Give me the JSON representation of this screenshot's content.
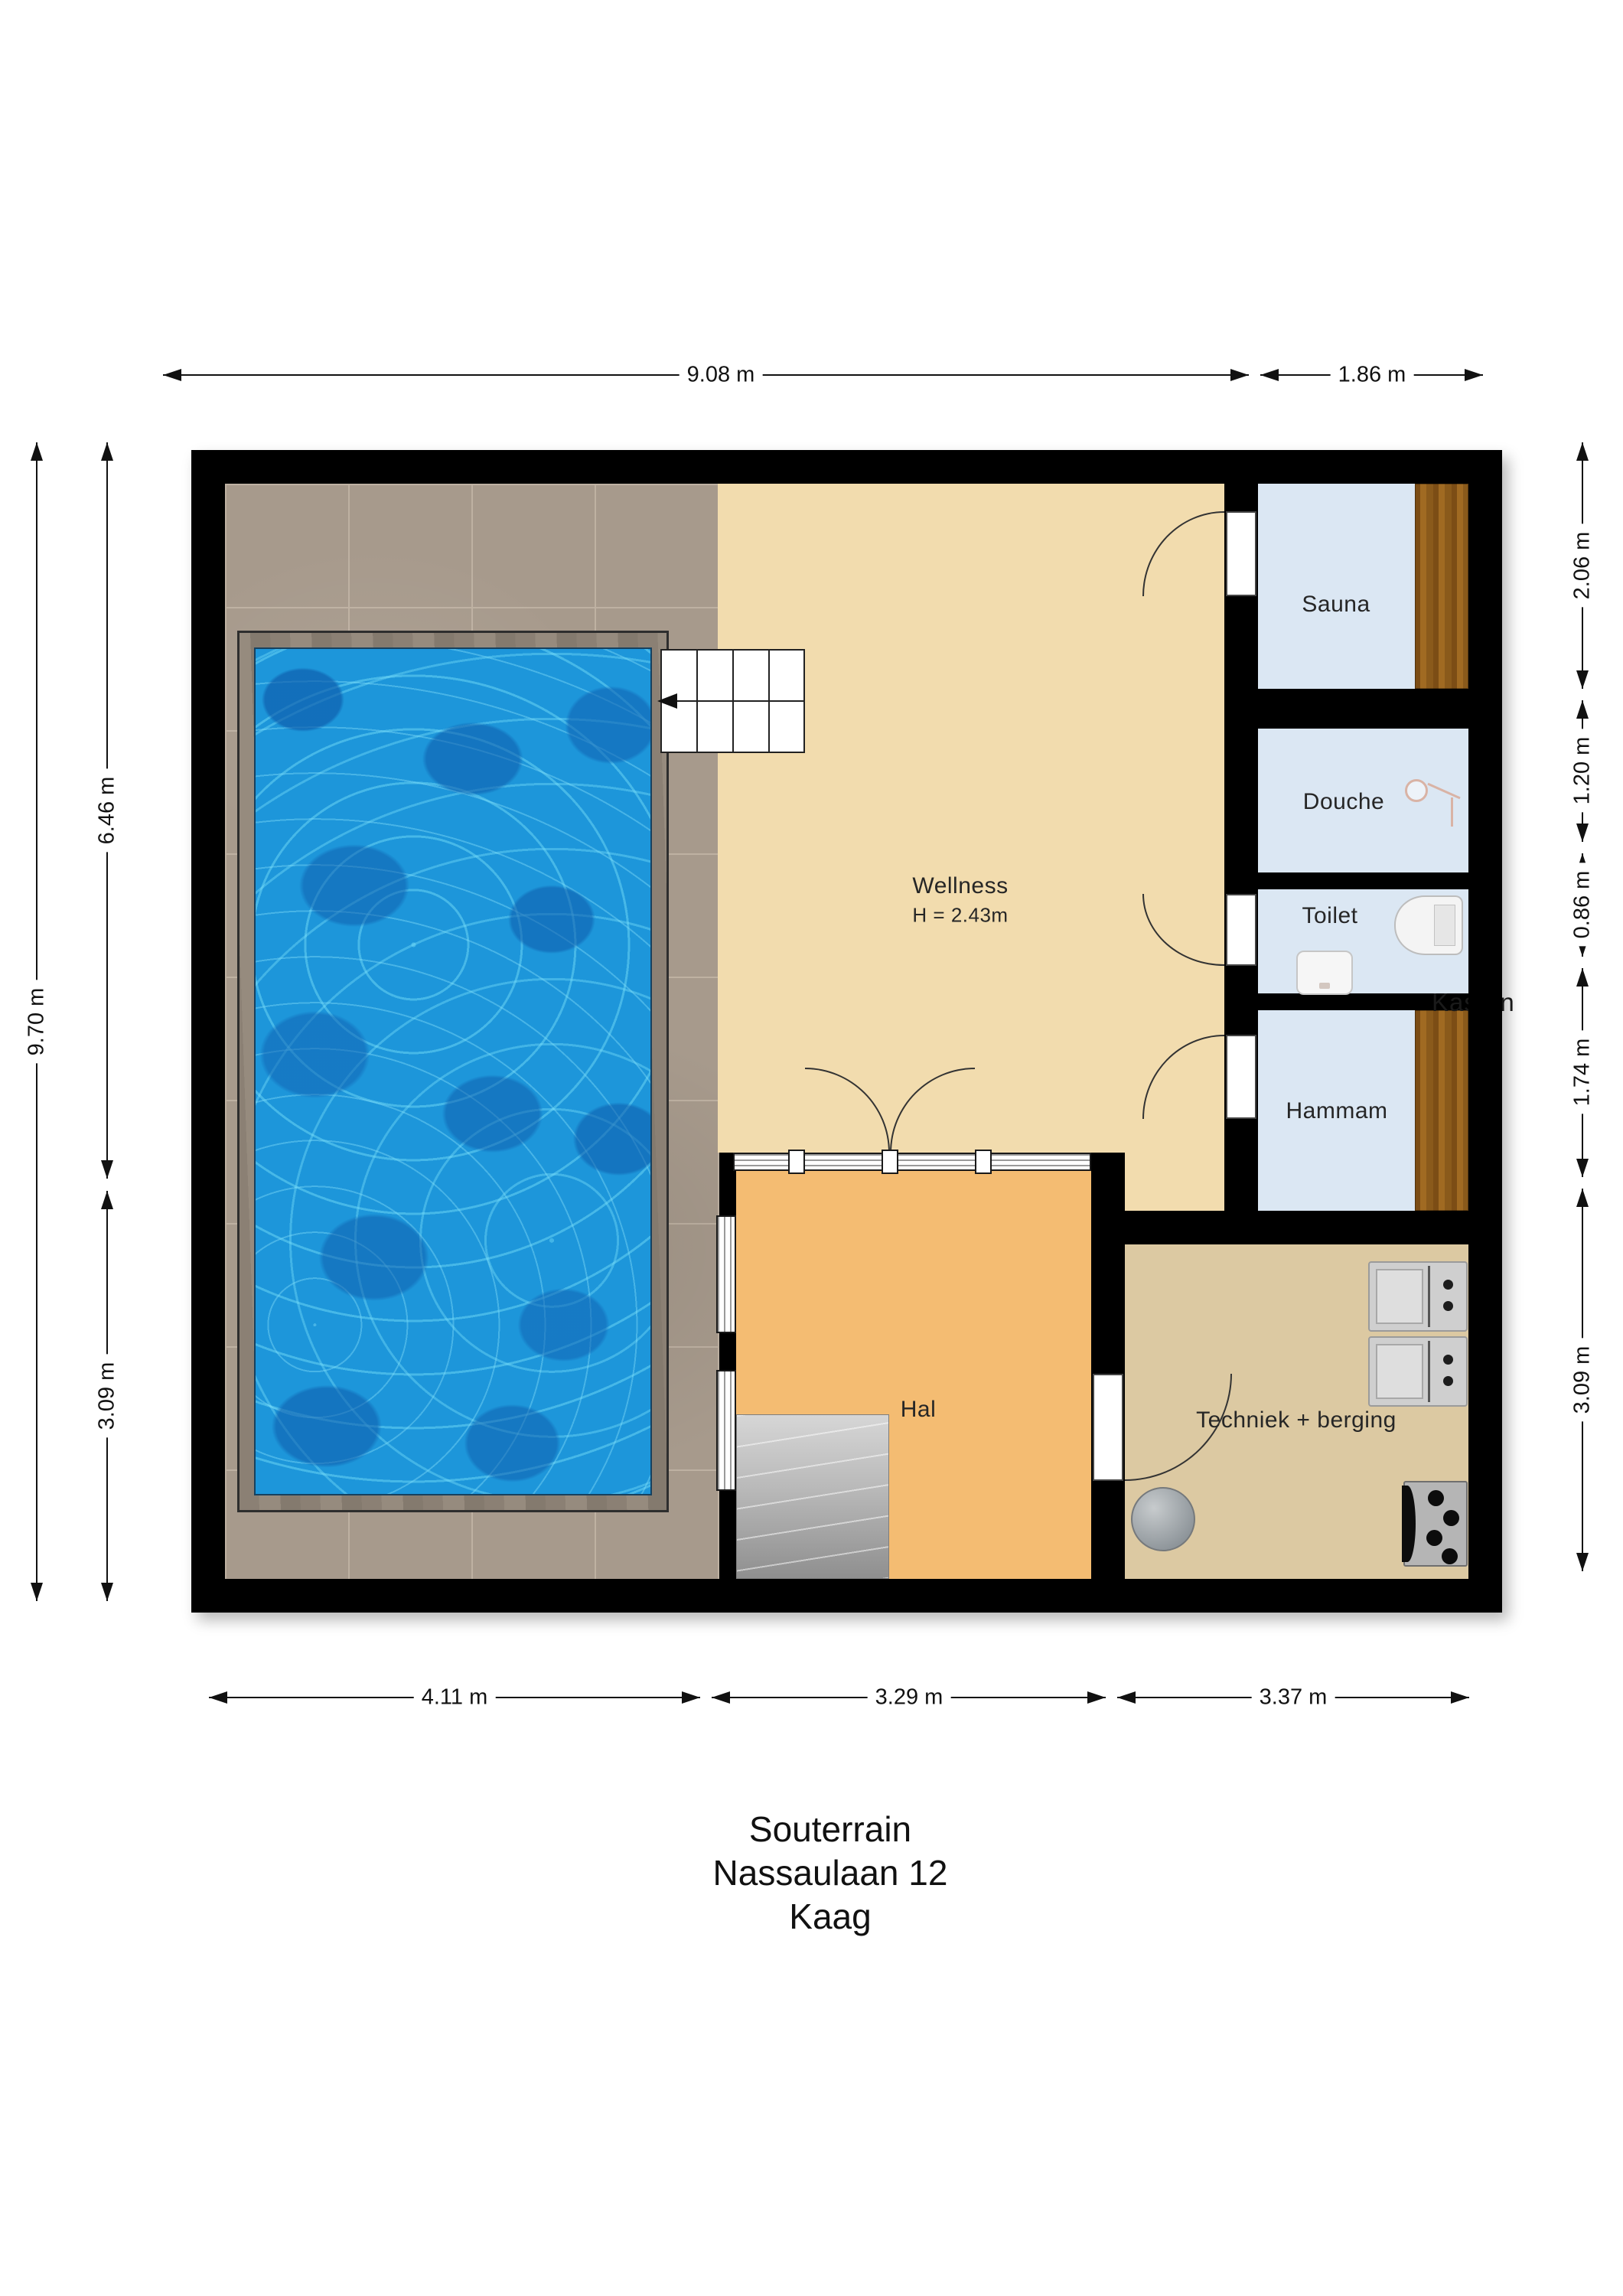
{
  "title": {
    "line1": "Souterrain",
    "line2": "Nassaulaan 12",
    "line3": "Kaag"
  },
  "rooms": {
    "wellness": {
      "label": "Wellness",
      "height_note": "H = 2.43m"
    },
    "sauna": {
      "label": "Sauna"
    },
    "douche": {
      "label": "Douche"
    },
    "toilet": {
      "label": "Toilet"
    },
    "hammam": {
      "label": "Hammam"
    },
    "hal": {
      "label": "Hal"
    },
    "techniek": {
      "label": "Techniek + berging"
    },
    "kasten": {
      "label": "Kasten"
    }
  },
  "dimensions": {
    "top": [
      {
        "label": "9.08 m"
      },
      {
        "label": "1.86 m"
      }
    ],
    "left": [
      {
        "label": "9.70 m"
      },
      {
        "label": "6.46 m"
      },
      {
        "label": "3.09 m"
      }
    ],
    "right": [
      {
        "label": "2.06 m"
      },
      {
        "label": "1.20 m"
      },
      {
        "label": "0.86 m"
      },
      {
        "label": "1.74 m"
      },
      {
        "label": "3.09 m"
      }
    ],
    "bottom": [
      {
        "label": "4.11 m"
      },
      {
        "label": "3.29 m"
      },
      {
        "label": "3.37 m"
      }
    ]
  },
  "colors": {
    "wall": "#000000",
    "pool_water": "#1d96da",
    "pool_coping": "#8b8074",
    "tile_floor": "#a79a8c",
    "wellness_floor": "#f2dcae",
    "hal_floor": "#f4bc72",
    "techniek_floor": "#dcc9a2",
    "wet_room_blue": "#dbe7f3",
    "sauna_wood": "#8a5a1b",
    "stairs_grey": "#b5b5b5"
  }
}
